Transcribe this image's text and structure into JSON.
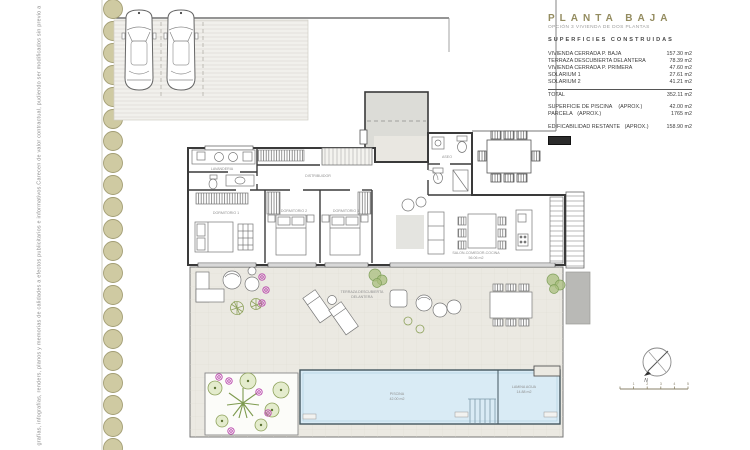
{
  "disclaimer": {
    "text": "grafías, infografías, renders, planos y memorias de calidades a efectos publicitarios e informativos.Carecen de valor contractual, pudiendo ser modificados sin previo aviso"
  },
  "title_block": {
    "title": "PLANTA BAJA",
    "subtitle": "OPCIÓN 3 VIVIENDA DE DOS PLANTAS",
    "section_heading": "SUPERFICIES CONSTRUIDAS",
    "rows": [
      {
        "label": "VIVIENDA CERRADA P. BAJA",
        "value": "157.30 m2"
      },
      {
        "label": "TERRAZA DESCUBIERTA DELANTERA",
        "value": "78.39 m2"
      },
      {
        "label": "VIVIENDA CERRADA P. PRIMERA",
        "value": "47.60 m2"
      },
      {
        "label": "SOLARIUM 1",
        "value": "27.61 m2"
      },
      {
        "label": "SOLARIUM 2",
        "value": "41.21 m2"
      }
    ],
    "total": {
      "label": "TOTAL",
      "value": "352.11 m2"
    },
    "extra_rows": [
      {
        "label": "SUPERFICIE DE PISCINA    (APROX.)",
        "value": "42.00 m2"
      },
      {
        "label": "PARCELA   (APROX.)",
        "value": "1765 m2"
      },
      {
        "label": "EDIFICABILIDAD RESTANTE   (APROX.)",
        "value": "158.90 m2"
      }
    ],
    "legend_swatch_color": "#2b2b2b"
  },
  "plan": {
    "room_labels": {
      "lavanderia": "LAVANDERIA",
      "distribuidor": "DISTRIBUIDOR",
      "aseo": "ASEO",
      "dormitorio1": "DORMITORIO 1",
      "dormitorio2": "DORMITORIO 2",
      "dormitorio3": "DORMITORIO 3",
      "salon": "SALON-COMEDOR-COCINA",
      "salon_area": "56.06 m2",
      "terraza": "TERRAZA DESCUBIERTA",
      "terraza2": "DELANTERA",
      "piscina": "PISCINA",
      "piscina_area": "42.00 m2",
      "lamina": "LAMINA AGUA",
      "lamina_area": "14.88 m2"
    },
    "compass": {
      "north_label": "N"
    },
    "scale_bar": {
      "ticks": [
        "1",
        "2",
        "3",
        "4",
        "5"
      ]
    },
    "colors": {
      "hedge": "#cfcaa2",
      "terrace": "#ebe9e2",
      "pool_water": "#d9ebf5",
      "flower_magenta": "#b842ab",
      "plant_olive": "#8ea25c",
      "title_olive": "#948c60",
      "upper_floor_gray": "#dcdcd7",
      "legend_black": "#2b2b2b"
    }
  }
}
